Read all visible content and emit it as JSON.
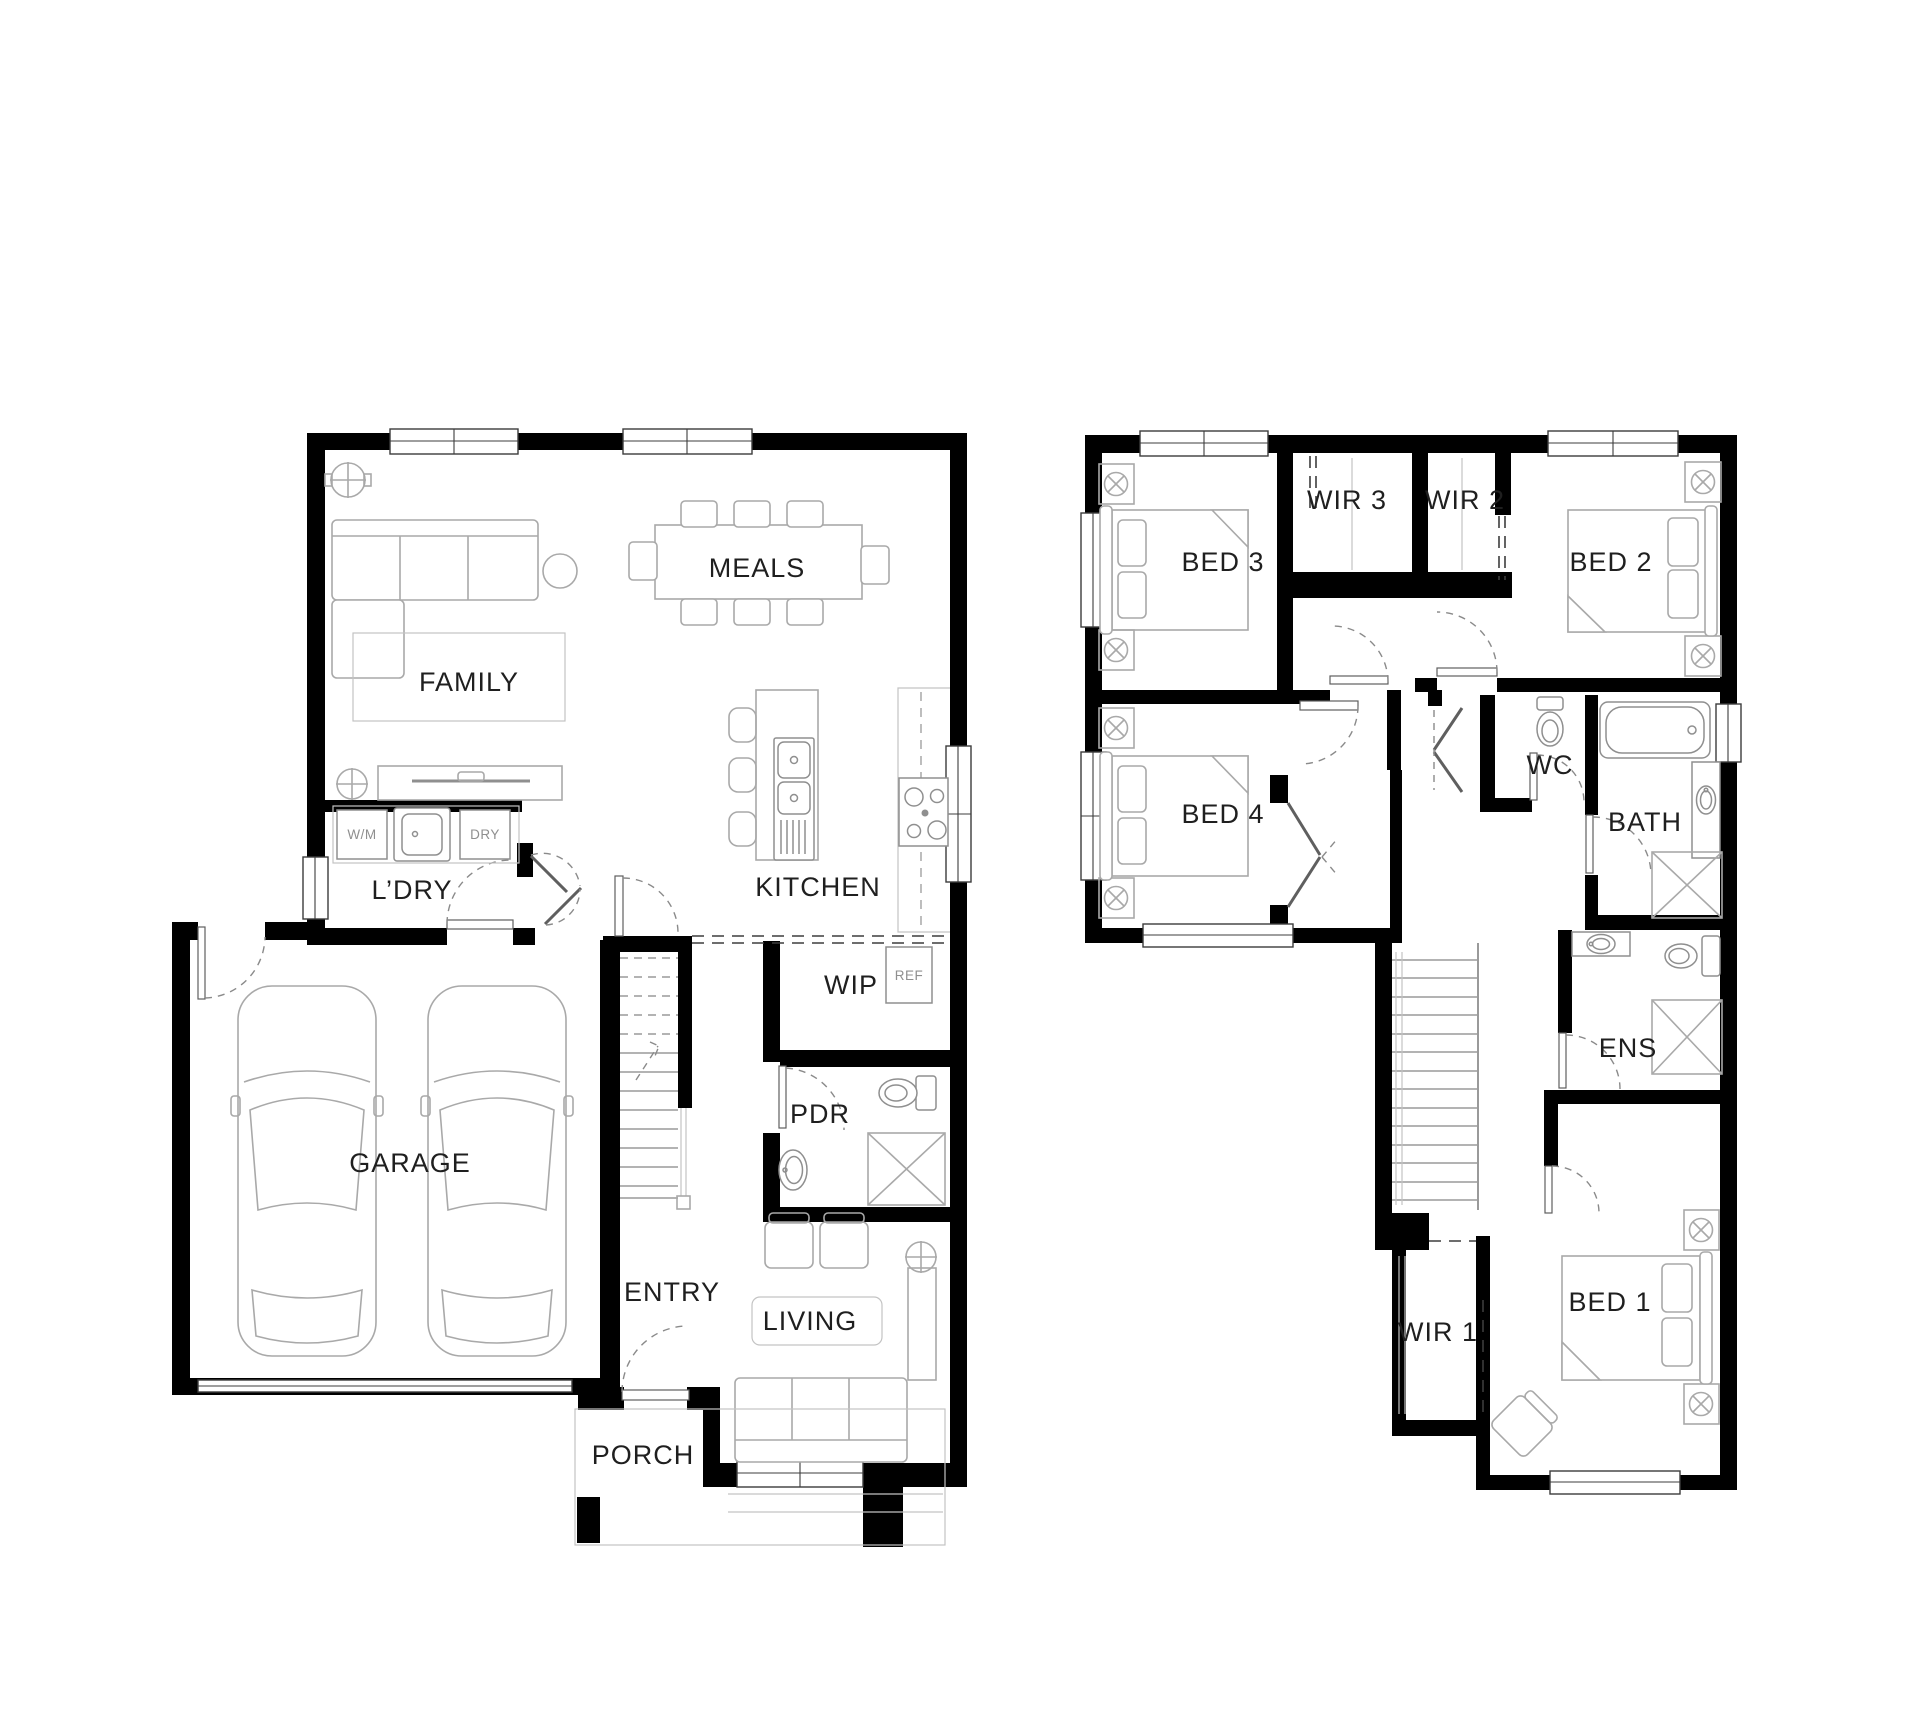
{
  "colors": {
    "wall": "#000000",
    "furniture_line": "#a9a9a9",
    "label": "#1f1f1f",
    "small_label": "#8f8f8f",
    "background": "#ffffff"
  },
  "ground_floor": {
    "family": "FAMILY",
    "meals": "MEALS",
    "kitchen": "KITCHEN",
    "laundry": "L’DRY",
    "washing_machine": "W/M",
    "dryer": "DRY",
    "garage": "GARAGE",
    "pantry": "WIP",
    "fridge": "REF",
    "powder": "PDR",
    "entry": "ENTRY",
    "living": "LIVING",
    "porch": "PORCH"
  },
  "first_floor": {
    "bed3": "BED 3",
    "wir3": "WIR 3",
    "wir2": "WIR 2",
    "bed2": "BED 2",
    "bed4": "BED 4",
    "wc": "WC",
    "bath": "BATH",
    "ens": "ENS",
    "wir1": "WIR 1",
    "bed1": "BED 1"
  }
}
